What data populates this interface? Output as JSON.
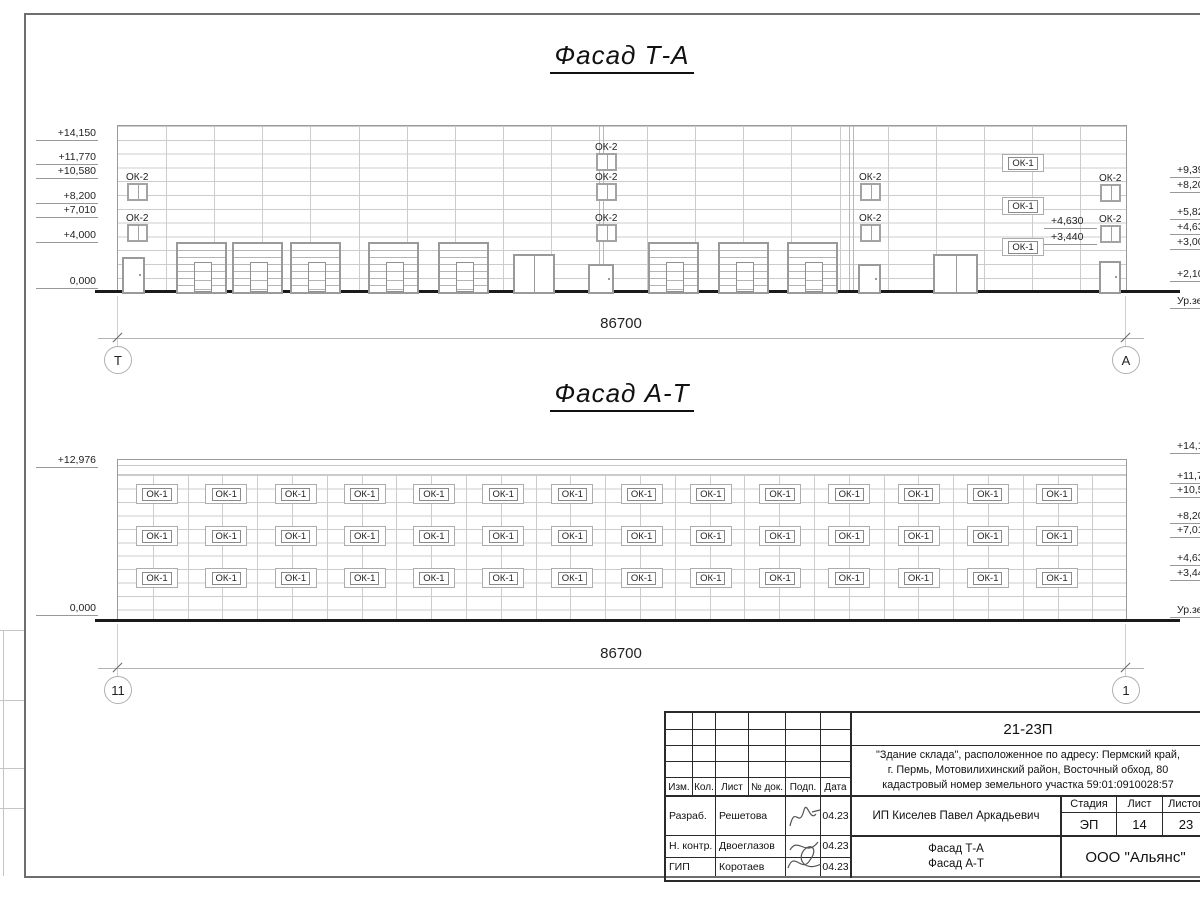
{
  "labels": {
    "ok1": "ОК-1",
    "ok2": "ОК-2"
  },
  "facade_top": {
    "title": "Фасад Т-А",
    "dimension": "86700",
    "axis_left": "Т",
    "axis_right": "А",
    "elev_left": [
      "+14,150",
      "+11,770",
      "+10,580",
      "+8,200",
      "+7,010",
      "+4,000",
      "0,000"
    ],
    "elev_right": [
      "+9,39",
      "+8,20",
      "+5,82",
      "+4,63",
      "+3,00",
      "+2,10",
      "Ур.зе"
    ],
    "elev_inner": [
      "+4,630",
      "+3,440"
    ]
  },
  "facade_bottom": {
    "title": "Фасад А-Т",
    "dimension": "86700",
    "axis_left": "11",
    "axis_right": "1",
    "elev_left": [
      "+12,976",
      "0,000"
    ],
    "elev_right": [
      "+14,15",
      "+11,77",
      "+10,58",
      "+8,20",
      "+7,01",
      "+4,63",
      "+3,44",
      "Ур.зе"
    ],
    "window_rows": 3,
    "window_cols": 14
  },
  "title_block": {
    "code": "21-23П",
    "description_lines": [
      "\"Здание склада\", расположенное по адресу: Пермский край,",
      "г. Пермь, Мотовилихинский район, Восточный обход, 80",
      "кадастровый номер земельного участка 59:01:0910028:57"
    ],
    "header_cols": [
      "Изм.",
      "Кол.",
      "Лист",
      "№ док.",
      "Подп.",
      "Дата"
    ],
    "rows": [
      {
        "role": "Разраб.",
        "name": "Решетова",
        "date": "04.23"
      },
      {
        "role": "Н. контр.",
        "name": "Двоеглазов",
        "date": "04.23"
      },
      {
        "role": "ГИП",
        "name": "Коротаев",
        "date": "04.23"
      }
    ],
    "client": "ИП Киселев Павел Аркадьевич",
    "stage_label": "Стадия",
    "sheet_label": "Лист",
    "sheets_label": "Листов",
    "stage": "ЭП",
    "sheet_no": "14",
    "sheets_total": "23",
    "drawing_names": [
      "Фасад Т-А",
      "Фасад А-Т"
    ],
    "company": "ООО \"Альянс\""
  }
}
